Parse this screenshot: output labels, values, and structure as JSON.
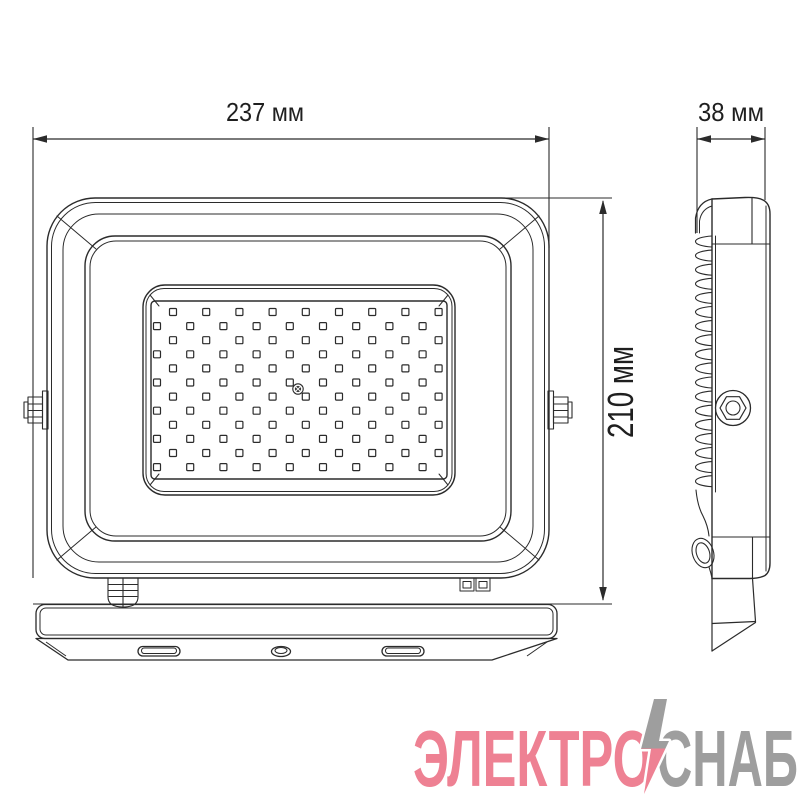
{
  "drawing": {
    "line_color": "#2b2b2b",
    "text_color": "#1f1f1f",
    "dimensions": {
      "width_label": "237 мм",
      "depth_label": "38 мм",
      "height_label": "210 мм"
    },
    "front_view": {
      "led_grid": {
        "rows": 12,
        "cols": 9,
        "x_start_odd": 173,
        "x_start_even": 157,
        "y_start": 312,
        "x_pitch": 33.2,
        "y_pitch": 14.1,
        "size": 7
      },
      "screw_center": {
        "x": 298,
        "y": 389
      }
    },
    "side_view": {
      "fins": {
        "count": 18,
        "y_start": 236,
        "pitch": 14.1,
        "tip_x": 695.5,
        "base_x": 712,
        "height": 11
      }
    },
    "watermark": {
      "text_primary": "ЭЛЕКТРО",
      "text_secondary": "СНАБ",
      "color_primary": "#ee8193",
      "color_secondary": "#9e9e9e"
    }
  }
}
